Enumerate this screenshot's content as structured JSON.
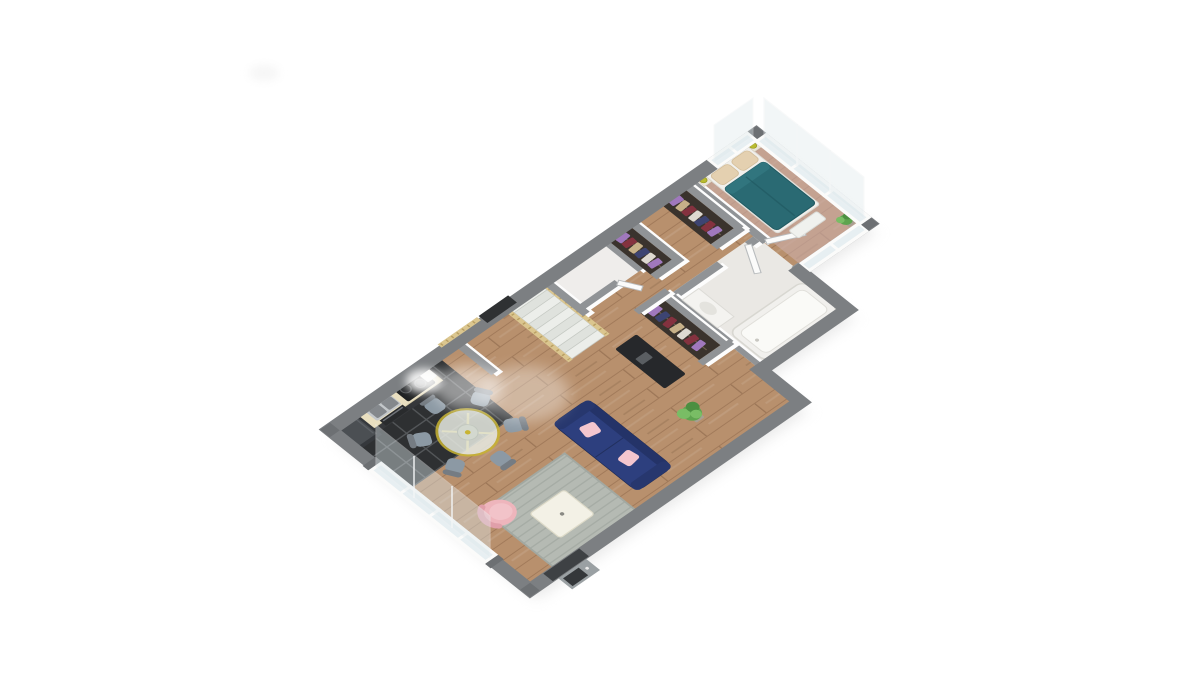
{
  "scene": {
    "description": "3D isometric rendering of a single-storey apartment floor plan, rotated, centered on a plain white background. No text or UI controls are visible.",
    "background_color": "#ffffff",
    "artifacts": [
      "faint gray smudge upper-left of canvas"
    ]
  },
  "rooms": [
    {
      "name": "kitchen",
      "floor": "black tiles",
      "items": [
        "refrigerator",
        "counter with double sink",
        "black cooktop with steam",
        "built-in oven",
        "small white appliance"
      ]
    },
    {
      "name": "dining-area",
      "items": [
        "round glass table with yellow frame",
        "six gray-blue chairs"
      ]
    },
    {
      "name": "living-room",
      "items": [
        "navy sofa with two pink cushions",
        "gray rug",
        "white coffee table",
        "pink armchair",
        "green plant",
        "front door with outside doorstep"
      ]
    },
    {
      "name": "staircase",
      "items": [
        "white steps",
        "pine wood railings",
        "dark landing piece"
      ]
    },
    {
      "name": "wc",
      "items": [
        "small white room with open door"
      ]
    },
    {
      "name": "hallway",
      "items": [
        "open wardrobe with clothes x3",
        "black desk"
      ]
    },
    {
      "name": "bathroom",
      "items": [
        "bathtub",
        "white basin cabinet",
        "open door"
      ]
    },
    {
      "name": "bedroom",
      "items": [
        "double bed with teal duvet",
        "two beige pillows",
        "two nightstands with chartreuse lamps",
        "white bench",
        "mauve carpet",
        "glass window walls",
        "small plant"
      ]
    }
  ],
  "counts": {
    "wardrobes": 3,
    "dining_chairs": 6,
    "sofa_cushions": 2,
    "stair_steps": 9,
    "sw_window_mullions": 3
  },
  "colors": {
    "background": "#ffffff",
    "ground_shadow": "#d8d8d8",
    "wall_outer_face": "#ebebea",
    "wall_exterior": "#7c7f82",
    "wall_pier": "#6d7073",
    "wall_interior_top": "#909396",
    "wall_face": "#fdfdfd",
    "wood_base": "#b8906d",
    "kitchen_tile": "#2e3032",
    "tile_line": "#54575a",
    "bathroom_floor": "#eae8e4",
    "wc_floor": "#efedeb",
    "bedroom_carpet": "#ccada8",
    "headboard_wall": "#d8bb97",
    "rug_base": "#b5bab3",
    "rug_line": "#a6aca5",
    "rug_border": "#a2a8a1",
    "coffee_table": "#f3f1e6",
    "coffee_table_edge": "#dedbc9",
    "armchair": "#eeb5bc",
    "armchair_seat": "#f2c3c9",
    "armchair_back": "#e09fa9",
    "sofa_body": "#2d3f7e",
    "sofa_back": "#243368",
    "sofa_arm": "#27376e",
    "sofa_cushion": "#f4c6ce",
    "table_top": "#e7eae2",
    "table_rim": "#c8b433",
    "table_inner": "#d3d8cf",
    "chair_seat": "#8c99a4",
    "chair_back": "#757c83",
    "counter_top": "#e9dfc0",
    "counter_base": "#35373a",
    "sink_frame": "#c3c7ca",
    "sink_basin": "#84888c",
    "faucet": "#d4d8da",
    "cooktop": "#1f2122",
    "burner": "#2c2e30",
    "burner_ring": "#55585a",
    "oven": "#292b2d",
    "oven_handle": "#70747a",
    "small_appliance": "#f1f1ee",
    "fridge_face": "#35383c",
    "fridge_top": "#4b4f53",
    "stair_step_a": "#eceeea",
    "stair_step_b": "#dfe2dd",
    "stair_edge": "#c6cac4",
    "railing_wood": "#dbc68f",
    "railing_dark": "#b99f63",
    "landing_dark": "#2f3133",
    "wardrobe_interior": "#3a332d",
    "rod": "#6d5f4e",
    "clothes_purple": "#a078bd",
    "clothes_red": "#84323f",
    "clothes_tan": "#c7b189",
    "clothes_navy": "#3d4472",
    "clothes_light": "#ded9d1",
    "desk": "#26282b",
    "desk_item": "#5a5e62",
    "tub_outer": "#f1f0ed",
    "tub_inner": "#fafaf7",
    "tub_stroke": "#d8d7d1",
    "basin_white": "#f4f3f0",
    "door_leaf": "#fbfbfa",
    "door_leaf_stroke": "#b9bcbe",
    "bed_frame": "#f1f0ec",
    "bed_frame_stroke": "#dcdad4",
    "pillow": "#e4d0b0",
    "pillow_stroke": "#d3bd99",
    "duvet": "#2a6a73",
    "duvet_dark": "#215a62",
    "nightstand": "#eae4d6",
    "lamp": "#b9bb30",
    "lamp_stroke": "#999c20",
    "bench": "#f0f1ee",
    "bench_stroke": "#d9dbd7",
    "plant_dark": "#4c8f41",
    "plant_mid": "#5ea44f",
    "plant_light": "#79bd65",
    "plant_pot": "#a89f92",
    "door_dark": "#3e4144",
    "doorstep": "#9aa0a3",
    "door_mat": "#34373a",
    "door_dot": "#e9e9e9",
    "window_frame": "#fbfbfa",
    "glass": "#e7eff2",
    "glass_pane": "#dfe9ec",
    "pane_stroke": "#eef1f2",
    "steam": "#ffffff",
    "smudge": "#ededed"
  }
}
